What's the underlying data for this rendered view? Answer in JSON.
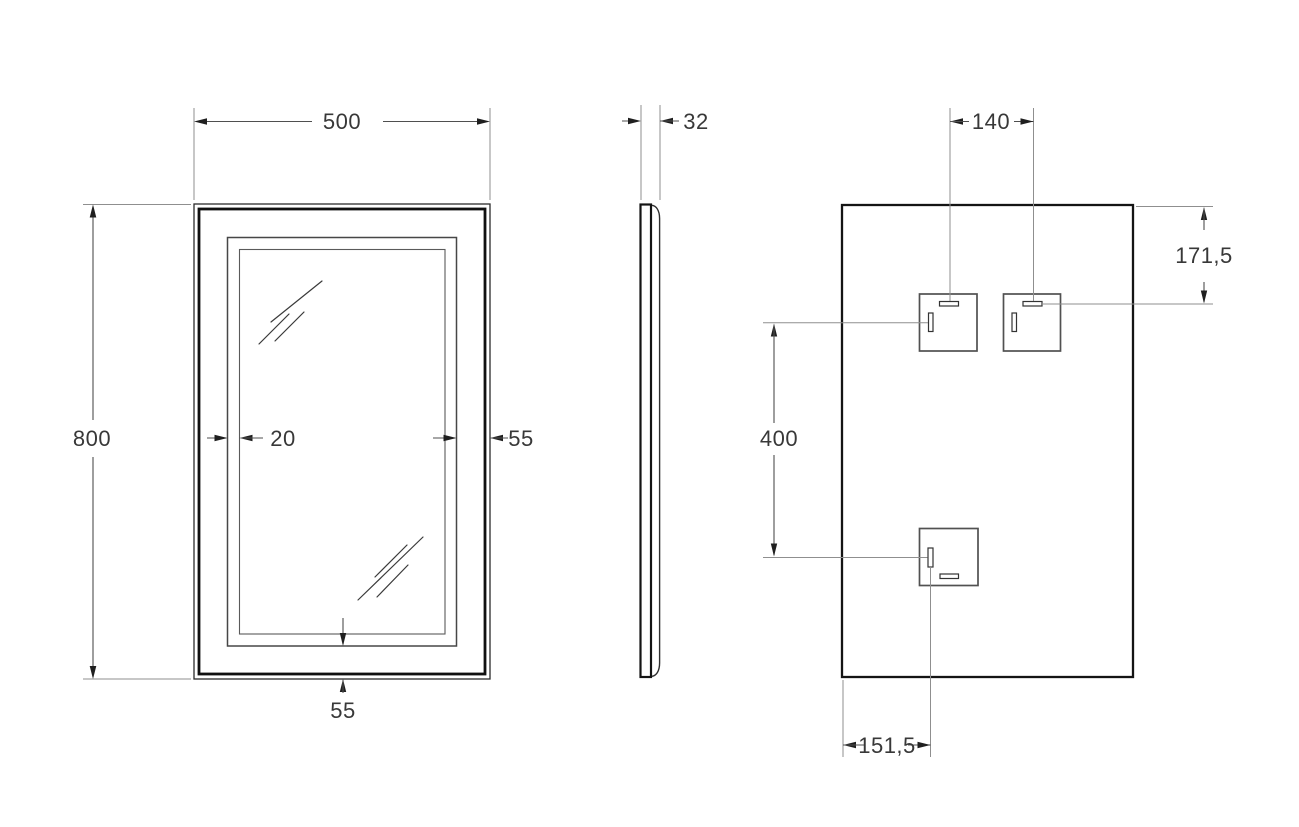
{
  "drawing": {
    "title": "mirror-technical-drawing",
    "front_view": {
      "dim_width": "500",
      "dim_height": "800",
      "dim_led_offset": "20",
      "dim_frame_side": "55",
      "dim_frame_bottom": "55"
    },
    "side_view": {
      "dim_depth": "32"
    },
    "back_view": {
      "dim_bracket_spacing": "140",
      "dim_top_to_bracket": "171,5",
      "dim_bracket_rows": "400",
      "dim_left_to_bracket": "151,5"
    },
    "colors": {
      "background": "#ffffff",
      "outline": "#101010",
      "dimension_lines": "#4f4f4f",
      "extension_lines": "#8f8f8f",
      "text": "#383838"
    }
  }
}
